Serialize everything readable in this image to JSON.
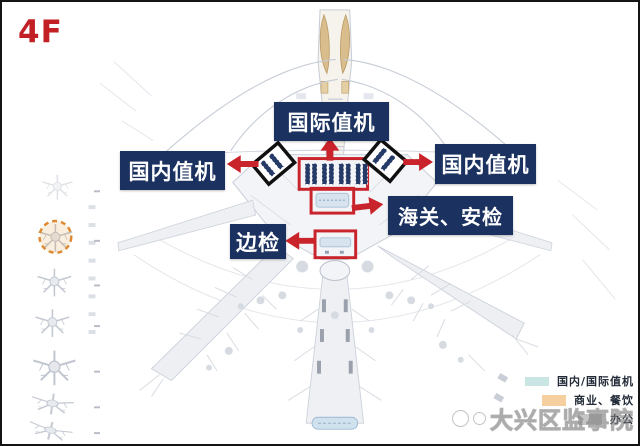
{
  "page": {
    "floor_label": "4F"
  },
  "callouts": {
    "international_checkin": "国际值机",
    "domestic_checkin_left": "国内值机",
    "domestic_checkin_right": "国内值机",
    "customs_security": "海关、安检",
    "border_inspection": "边检"
  },
  "legend": {
    "items": [
      {
        "label": "国内/国际值机",
        "color": "#c9e6e4"
      },
      {
        "label": "商业、餐饮",
        "color": "#f5cf9d"
      },
      {
        "label": "办公",
        "color": "#c6c6c6"
      }
    ]
  },
  "watermark": {
    "text": "大兴区监事院"
  },
  "colors": {
    "callout_bg": "#1b3160",
    "annotation_red": "#c9242b",
    "highlight_circle_orange": "#dd8a33",
    "north_pier_tan": "#d9bd8d",
    "plan_gray": "#c6ccd6"
  }
}
